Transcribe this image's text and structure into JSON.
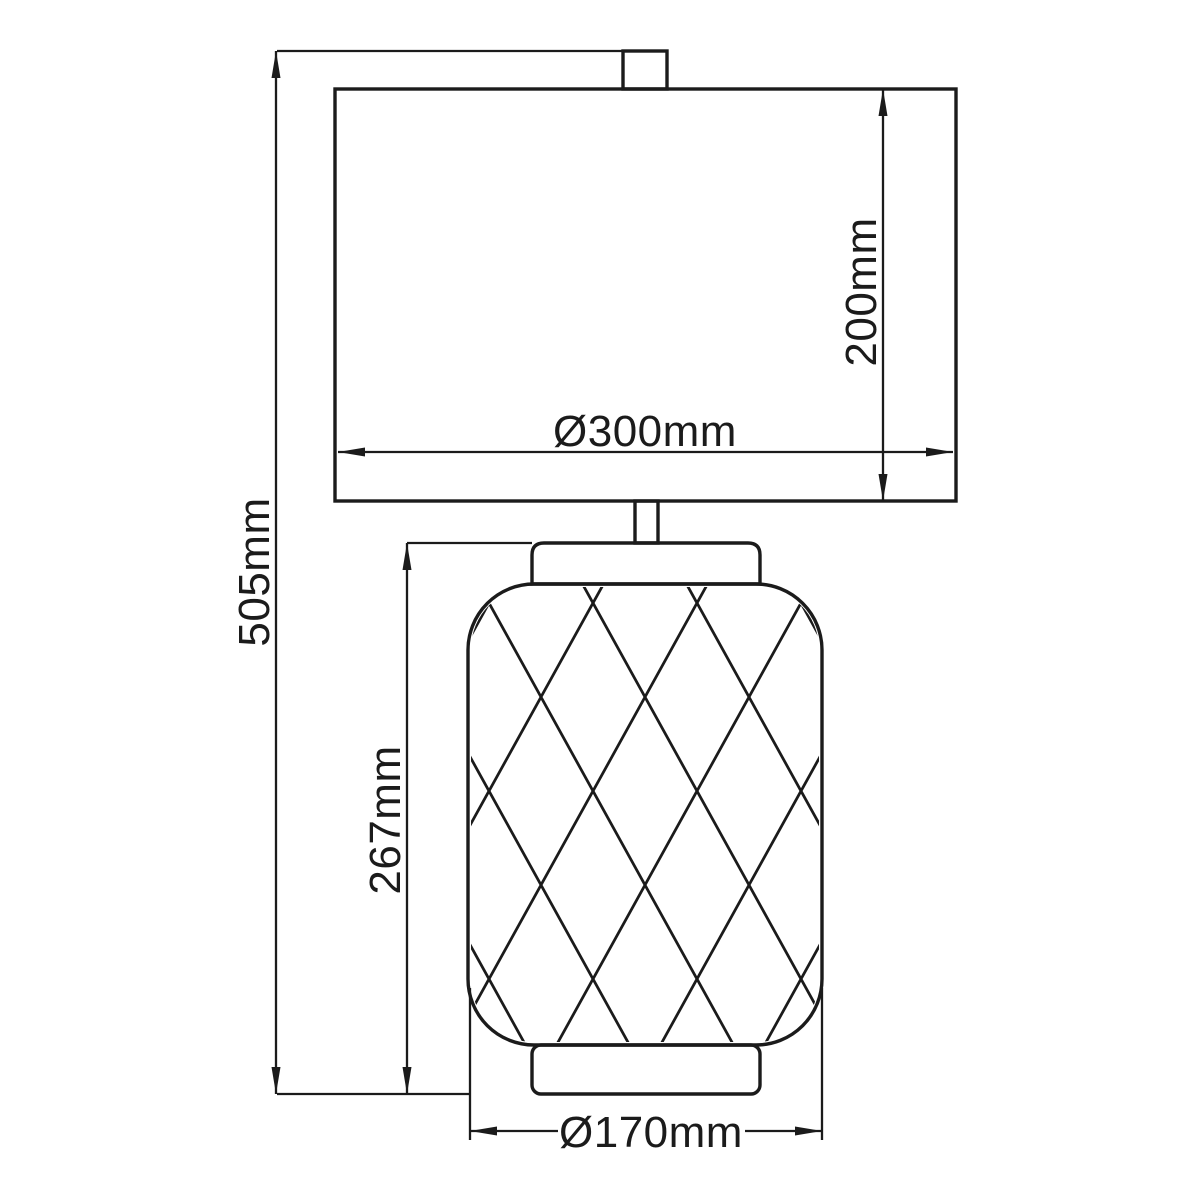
{
  "diagram": {
    "type": "technical-dimension-drawing",
    "subject": "table lamp with rectangular drum shade and diamond-lattice cylindrical body",
    "background_color": "#ffffff",
    "line_color": "#1b1b1b",
    "dimensions": {
      "total_height": {
        "label": "505mm",
        "orientation": "vertical",
        "measures": "overall lamp height from finial top to base bottom"
      },
      "shade_height": {
        "label": "200mm",
        "orientation": "vertical",
        "measures": "shade height"
      },
      "shade_diameter": {
        "label": "Ø300mm",
        "orientation": "horizontal",
        "measures": "shade diameter"
      },
      "body_height": {
        "label": "267mm",
        "orientation": "vertical",
        "measures": "lamp body height from neck top to base bottom"
      },
      "body_diameter": {
        "label": "Ø170mm",
        "orientation": "horizontal",
        "measures": "lamp body diameter"
      }
    }
  }
}
